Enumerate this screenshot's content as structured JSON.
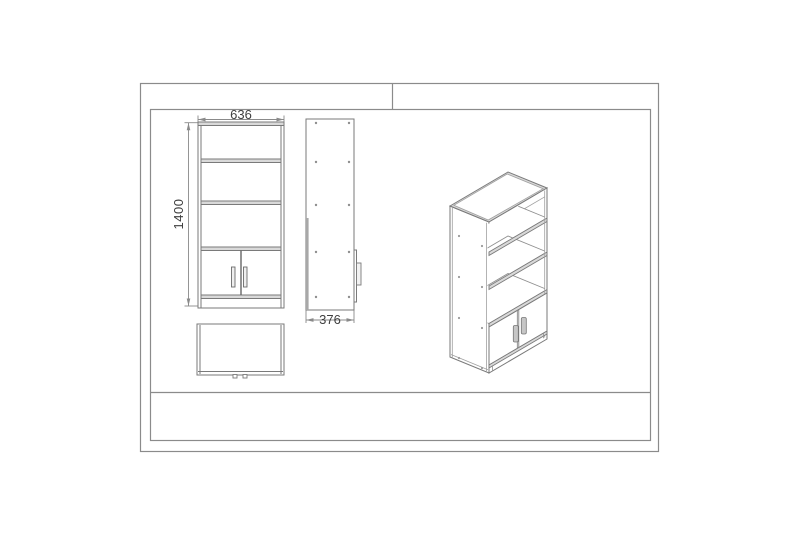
{
  "drawing": {
    "dimensions": {
      "width": "636",
      "height": "1400",
      "depth": "376"
    },
    "colors": {
      "background": "#ffffff",
      "frame_border": "#8b8b8b",
      "outline": "#7a7a7a",
      "panel_edge_fill": "#d9d9d9",
      "handle_fill": "#c6c6c6",
      "dimension_text": "#3f3f3f"
    }
  }
}
